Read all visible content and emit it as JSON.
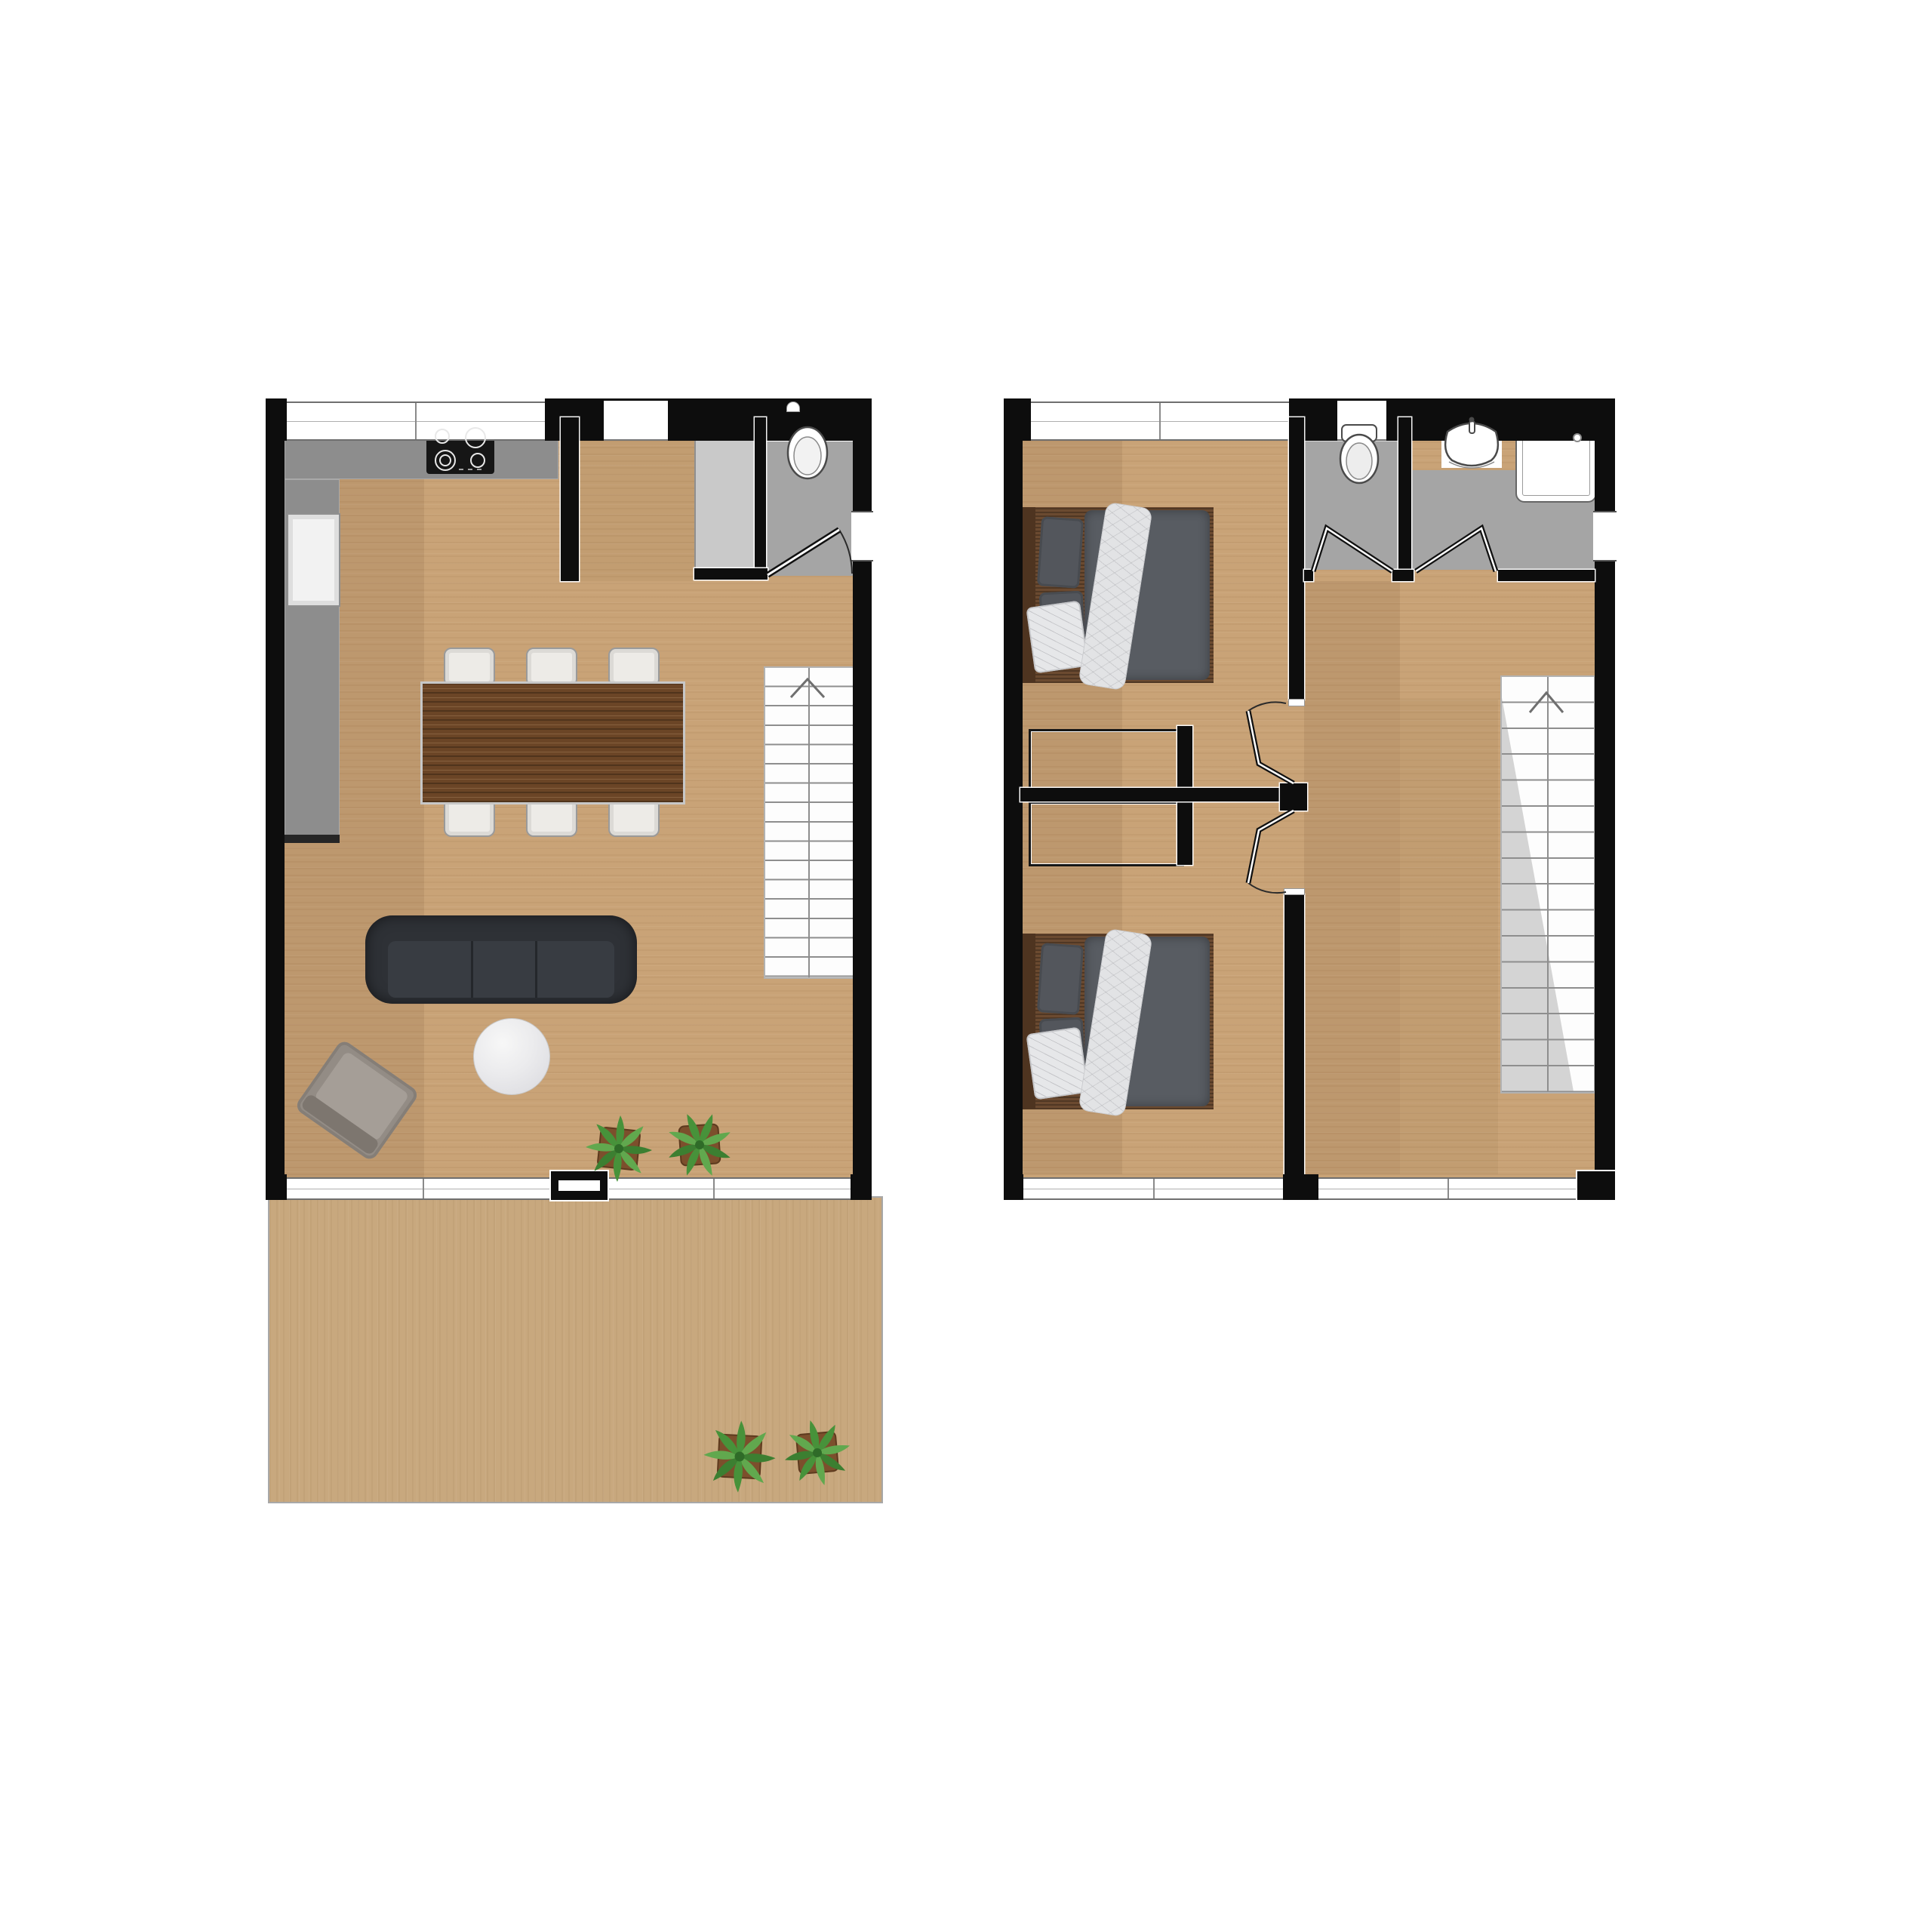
{
  "meta": {
    "type": "architectural-floor-plan",
    "floors_shown": 2,
    "no_visible_text": true
  },
  "colors": {
    "bg": "#ffffff",
    "wall": "#0d0d0d",
    "wood": "#c9a377",
    "terracewood": "#c8a87e",
    "counter": "#8d8d8d",
    "wetfloor": "#a5a5a5",
    "storage": "#c9c9c9",
    "cistern": "#d5d5d5",
    "tablewood": "#6b4526",
    "sofa": "#2e3136",
    "duvet": "#585c62",
    "stair_tri": "#d4d4d4",
    "plant_green": "#47923a",
    "plant_green2": "#61a84e",
    "pot_brown": "#7c4f2c"
  },
  "ground_floor": {
    "rooms": [
      {
        "name": "kitchen-living-dining",
        "floor": "wood"
      },
      {
        "name": "wc",
        "floor": "gray",
        "fixtures": [
          "toilet"
        ],
        "door": "swing"
      },
      {
        "name": "storage-nook",
        "floor": "light-gray"
      },
      {
        "name": "terrace",
        "floor": "wood-deck"
      }
    ],
    "kitchen": {
      "counter_shape": "L",
      "cooktop_burners": 4,
      "appliance_front": "sink-or-fridge"
    },
    "dining": {
      "table": 1,
      "chairs": 6
    },
    "living": {
      "sofa_seats": 3,
      "coffee_table": "round-marble",
      "armchair": 1,
      "potted_plants": 2
    },
    "terrace_plants": 2,
    "stairs": {
      "treads": 16,
      "direction_arrow": "up",
      "shading": "none"
    },
    "windows": {
      "top_wall": 2,
      "right_wall": 1,
      "bottom_wall_glazing": "full-width-sliding"
    }
  },
  "upper_floor": {
    "rooms": [
      {
        "name": "bedroom-1",
        "beds": 1,
        "closet": true
      },
      {
        "name": "bedroom-2",
        "beds": 1,
        "closet": true
      },
      {
        "name": "wc",
        "fixtures": [
          "toilet"
        ],
        "door": "bifold"
      },
      {
        "name": "bathroom",
        "fixtures": [
          "sink",
          "shower"
        ],
        "door": "bifold"
      },
      {
        "name": "hallway-landing"
      }
    ],
    "beds": {
      "count": 2,
      "style": "double, dark duvet, white patterned throw, wood headboard"
    },
    "stairs": {
      "treads": 16,
      "direction_arrow": "up",
      "shading": "diagonal-gray-triangle"
    },
    "doors": {
      "bedroom_doors": "bifold-on-center-post",
      "post": "black-square-node"
    },
    "windows": {
      "top_wall": 2,
      "right_wall": 1,
      "bottom_wall": 2
    }
  }
}
